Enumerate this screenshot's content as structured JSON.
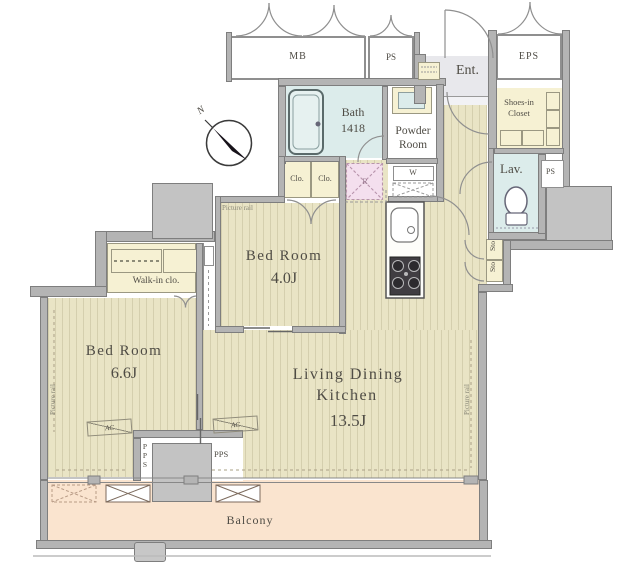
{
  "labels": {
    "mb": "MB",
    "ps_top": "PS",
    "eps": "EPS",
    "ent": "Ent.",
    "bath_l1": "Bath",
    "bath_l2": "1418",
    "powder_l1": "Powder",
    "powder_l2": "Room",
    "shoes_l1": "Shoes-in",
    "shoes_l2": "Closet",
    "lav": "Lav.",
    "ps_right": "PS",
    "sto_a": "Sto",
    "sto_b": "Sto",
    "clo_a": "Clo.",
    "clo_b": "Clo.",
    "fridge": "R",
    "washer": "W",
    "bed2_name": "Bed Room",
    "bed2_size": "4.0J",
    "bed1_name": "Bed Room",
    "bed1_size": "6.6J",
    "ldk_l1": "Living Dining",
    "ldk_l2": "Kitchen",
    "ldk_size": "13.5J",
    "walkin": "Walk-in clo.",
    "balcony": "Balcony",
    "pr_bed2": "Picture rail",
    "pr_bed1": "Picture rail",
    "pr_ldk": "Picture rail",
    "ac_bed1": "AC",
    "ac_ldk": "AC",
    "pps_left": "PPS",
    "pps_right": "PPS",
    "north": "N"
  },
  "colors": {
    "flooring": "#e9e4c5",
    "closet": "#f6f1d3",
    "wet_area": "#dceceb",
    "balcony": "#fae4cf",
    "wall": "#b4b4b4",
    "fridge_space": "#f4dfee",
    "text": "#4f4c45"
  }
}
